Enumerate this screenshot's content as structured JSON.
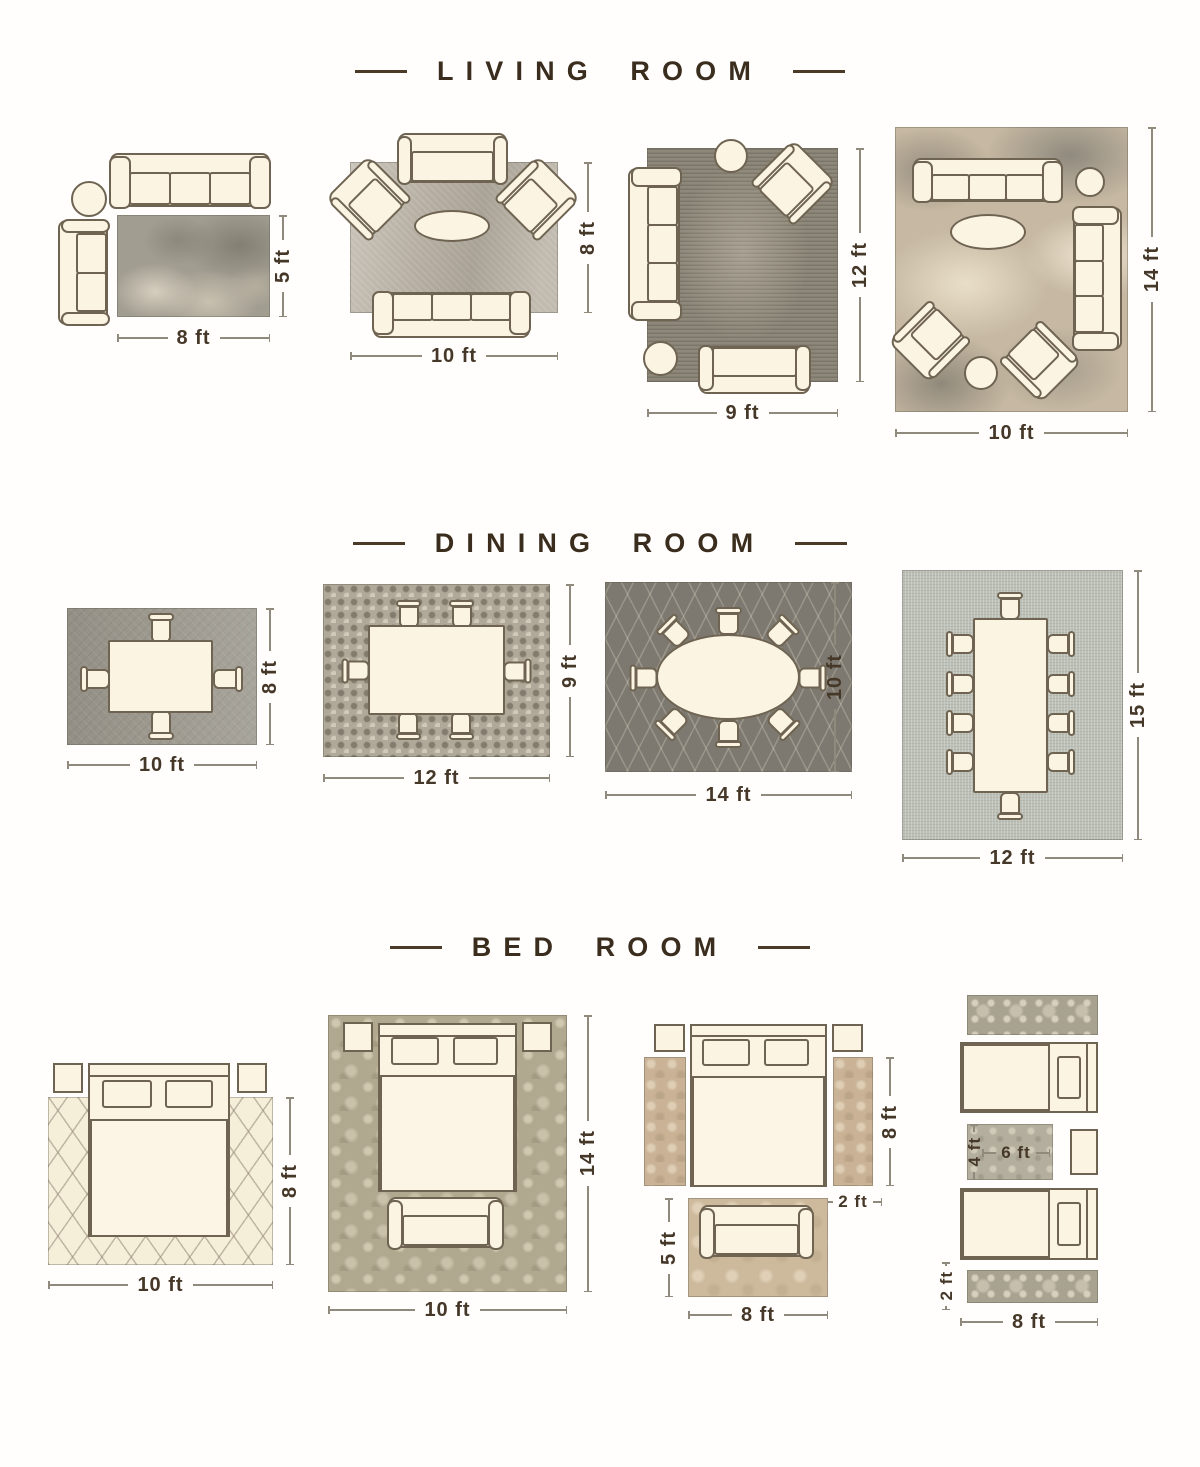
{
  "colors": {
    "background": "#fffefd",
    "furniture_outline": "#6f6452",
    "furniture_fill": "#fcf4e3",
    "title_text": "#3b2d1d",
    "dimension_text": "#463828",
    "dimension_line": "#8f8a7c"
  },
  "sections": [
    {
      "id": "living-room",
      "title": "LIVING ROOM",
      "layouts": [
        {
          "rug": "8 x 5 rug with sofa and loveseat beside it",
          "dims": {
            "w": "8 ft",
            "h": "5 ft"
          }
        },
        {
          "rug": "10 x 8 rug with sofa, loveseat and two accent chairs",
          "dims": {
            "w": "10 ft",
            "h": "8 ft"
          }
        },
        {
          "rug": "9 x 12 rug with sofa, loveseat, accent chair and ottoman",
          "dims": {
            "w": "9 ft",
            "h": "12 ft"
          }
        },
        {
          "rug": "10 x 14 rug with two sofas, two accent chairs and ottoman",
          "dims": {
            "w": "10 ft",
            "h": "14 ft"
          }
        }
      ]
    },
    {
      "id": "dining-room",
      "title": "DINING ROOM",
      "layouts": [
        {
          "rug": "10 x 8 rug, rectangular table with 4 chairs",
          "dims": {
            "w": "10 ft",
            "h": "8 ft"
          }
        },
        {
          "rug": "12 x 9 rug, rectangular table with 6 chairs",
          "dims": {
            "w": "12 ft",
            "h": "9 ft"
          }
        },
        {
          "rug": "14 x 10 rug, oval table with 8 chairs",
          "dims": {
            "w": "14 ft",
            "h": "10 ft"
          }
        },
        {
          "rug": "12 x 15 rug, long table with 10 chairs",
          "dims": {
            "w": "12 ft",
            "h": "15 ft"
          }
        }
      ]
    },
    {
      "id": "bed-room",
      "title": "BED ROOM",
      "layouts": [
        {
          "rug": "10 x 8 rug under lower two-thirds of bed",
          "dims": {
            "w": "10 ft",
            "h": "8 ft"
          }
        },
        {
          "rug": "10 x 14 rug under entire bed, nightstands and bench",
          "dims": {
            "w": "10 ft",
            "h": "14 ft"
          }
        },
        {
          "rug": "8 x 2 runners beside bed and 8 x 5 rug with bench",
          "dims": {
            "runner_h": "8 ft",
            "runner_w": "2 ft",
            "bench_rug_h": "5 ft",
            "bench_rug_w": "8 ft"
          }
        },
        {
          "rug": "twin beds with 8 x 2 runners and 6 x 4 rug between",
          "dims": {
            "mid_rug_h": "4 ft",
            "mid_rug_w": "6 ft",
            "runner_h": "2 ft",
            "w": "8 ft"
          }
        }
      ]
    }
  ]
}
